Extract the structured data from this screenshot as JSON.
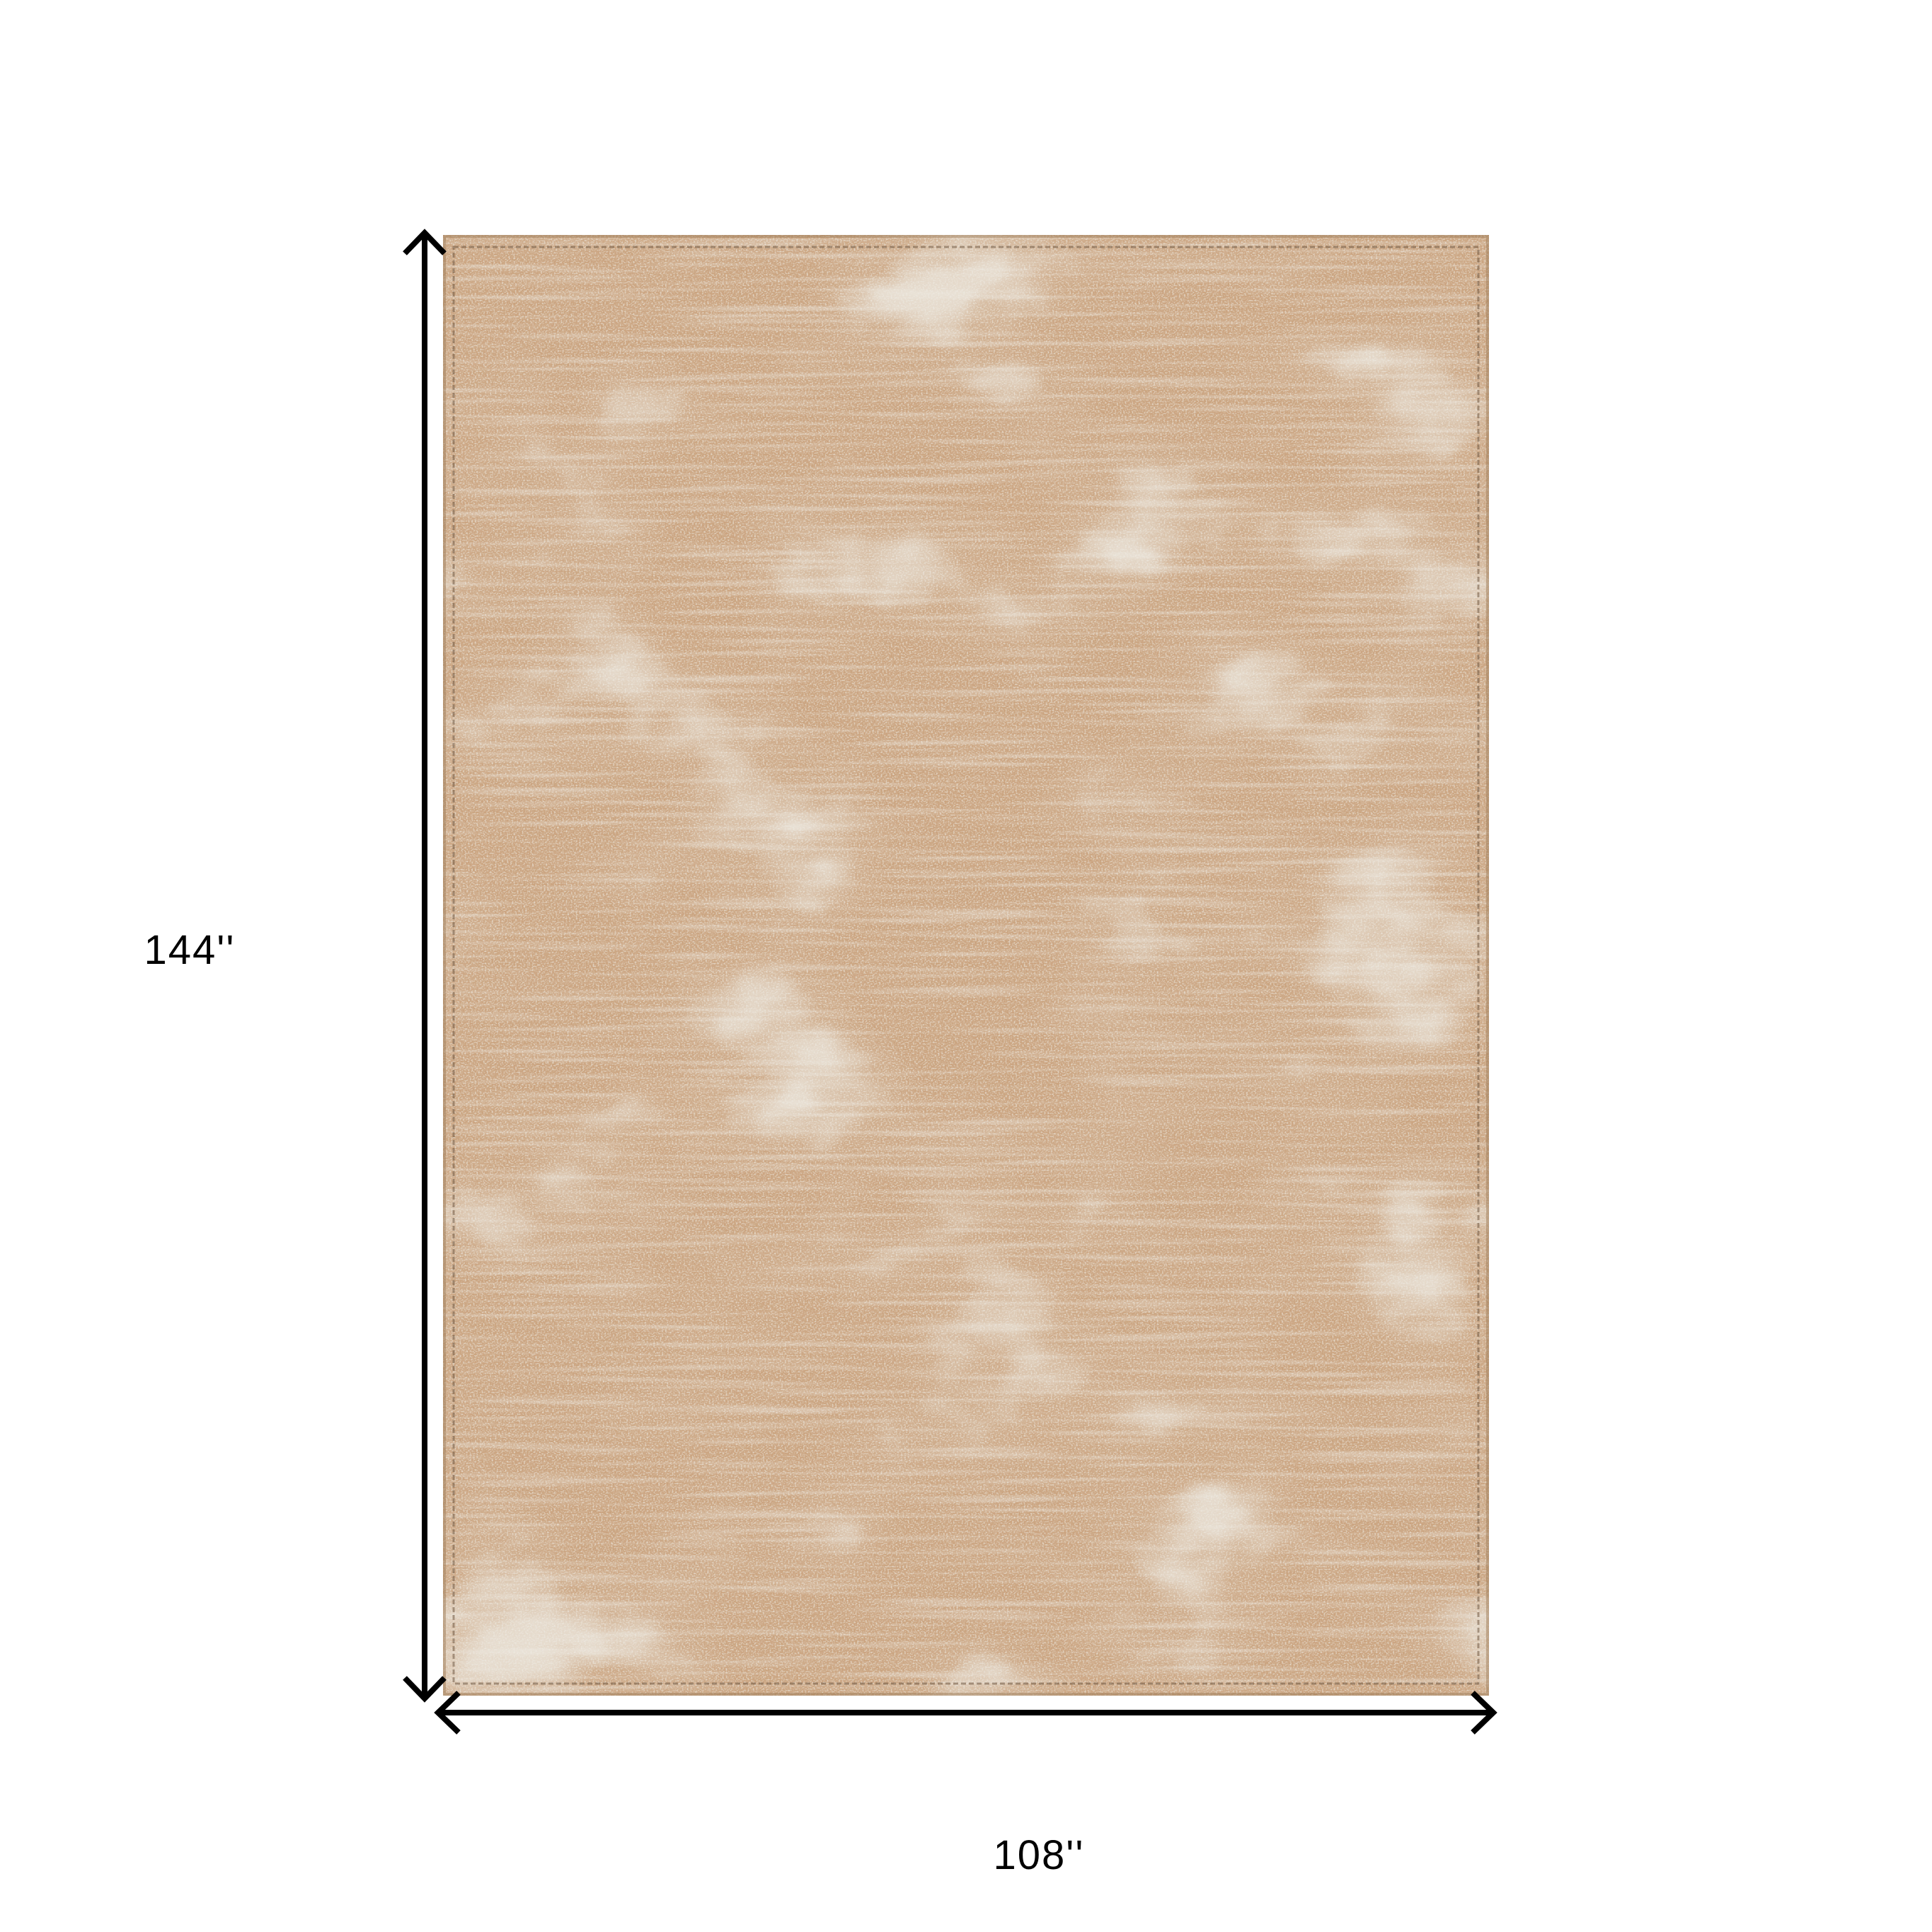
{
  "diagram": {
    "height_label": "144''",
    "width_label": "108''"
  },
  "colors": {
    "background": "#ffffff",
    "dimension_line": "#000000",
    "label_text": "#000000",
    "rug_base": "#c9a17c",
    "rug_light_accent": "#ded8c8",
    "rug_dark_accent": "#ab8158",
    "rug_stitch": "#6f5742",
    "rug_edge": "#9d7b57"
  }
}
